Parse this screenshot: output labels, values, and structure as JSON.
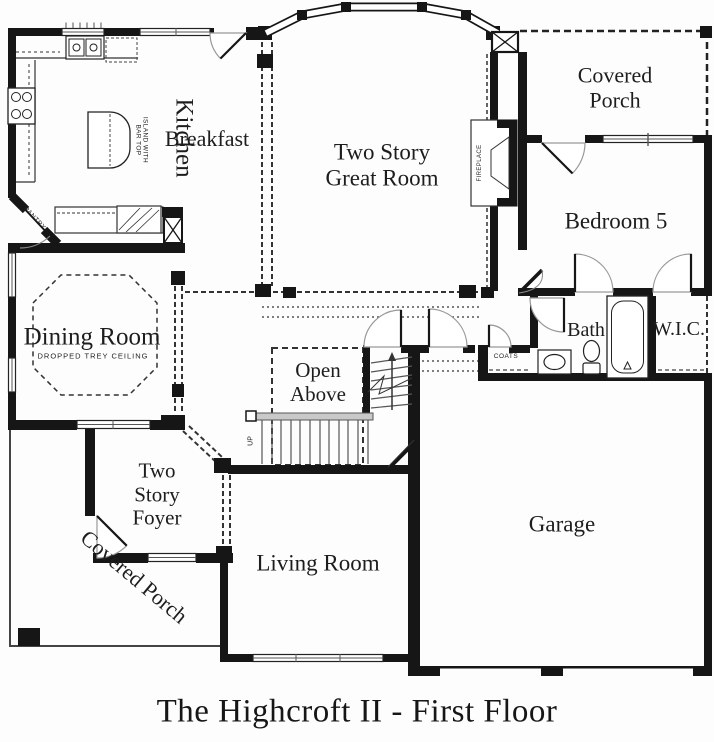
{
  "title": "The Highcroft II - First Floor",
  "rooms": {
    "kitchen": {
      "label": "Kitchen"
    },
    "breakfast": {
      "label": "Breakfast"
    },
    "great_room": {
      "line1": "Two Story",
      "line2": "Great Room"
    },
    "covered_porch_upper": {
      "line1": "Covered",
      "line2": "Porch"
    },
    "bedroom_5": {
      "label": "Bedroom 5"
    },
    "bath": {
      "label": "Bath"
    },
    "wic": {
      "label": "W.I.C."
    },
    "coats_closet": {
      "label": "COATS"
    },
    "dining_room": {
      "label": "Dining Room",
      "sublabel": "DROPPED TREY CEILING"
    },
    "open_above": {
      "line1": "Open",
      "line2": "Above"
    },
    "foyer": {
      "line1": "Two",
      "line2": "Story",
      "line3": "Foyer"
    },
    "covered_porch_lower": {
      "label": "Covered Porch"
    },
    "living_room": {
      "label": "Living Room"
    },
    "garage": {
      "label": "Garage"
    }
  },
  "annotations": {
    "island": {
      "line1": "ISLAND WITH",
      "line2": "BAR TOP"
    },
    "pantry": "PANTRY",
    "fireplace": "FIREPLACE",
    "stairs_direction": "UP"
  }
}
